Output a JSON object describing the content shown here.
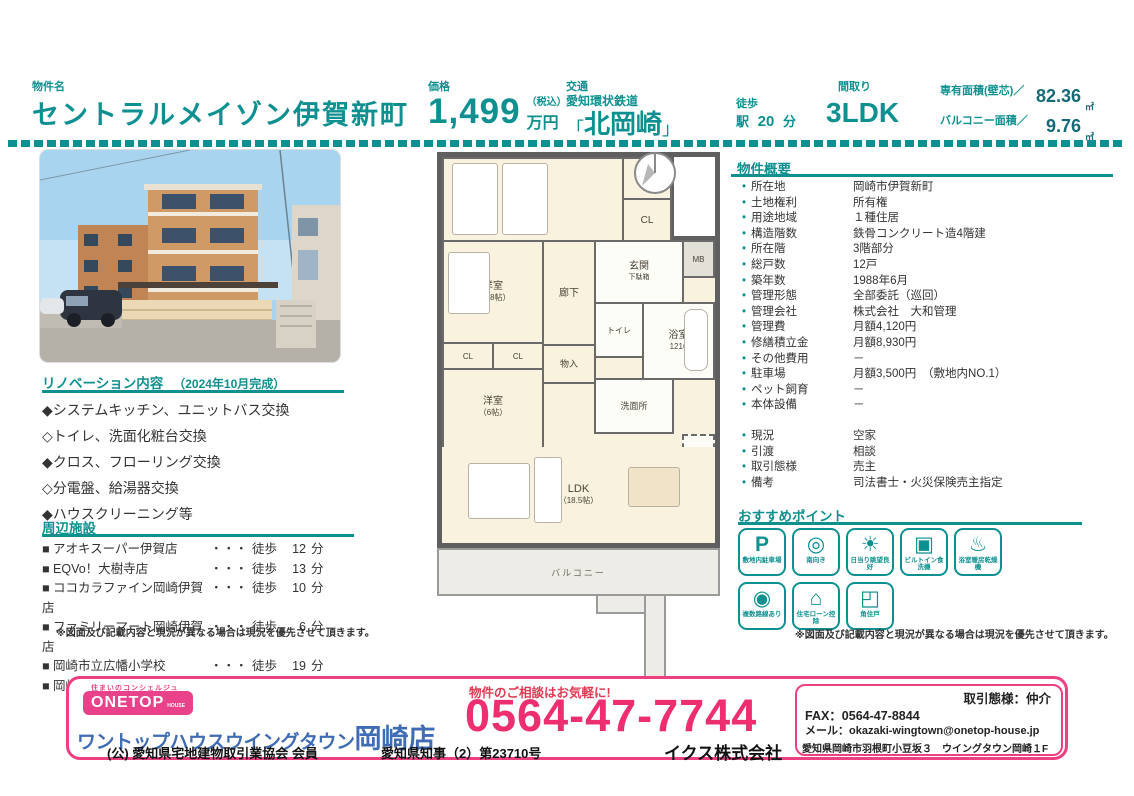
{
  "header": {
    "property_label": "物件名",
    "property_name": "セントラルメイゾン伊賀新町",
    "price_label": "価格",
    "price_value": "1,499",
    "price_tax": "（税込）",
    "price_unit": "万円",
    "access_label": "交通",
    "rail_line": "愛知環状鉄道",
    "bracket_open": "「",
    "station": "北岡崎",
    "bracket_close": "」",
    "walk_label": "徒歩",
    "station_suffix": "駅",
    "walk_minutes": "20",
    "minutes_unit": "分",
    "layout_label": "間取り",
    "layout_value": "3LDK",
    "area_label": "専有面積(壁芯)／",
    "area_value": "82.36",
    "area_unit": "㎡",
    "balcony_label": "バルコニー面積／",
    "balcony_value": "9.76",
    "balcony_unit": "㎡"
  },
  "renovation": {
    "title": "リノベーション内容",
    "completed": "（2024年10月完成）",
    "items": [
      "◆システムキッチン、ユニットバス交換",
      "◇トイレ、洗面化粧台交換",
      "◆クロス、フローリング交換",
      "◇分電盤、給湯器交換",
      "◆ハウスクリーニング等"
    ]
  },
  "facilities": {
    "title": "周辺施設",
    "dots": "・・・",
    "walk": "徒歩",
    "unit": "分",
    "items": [
      {
        "name": "■ アオキスーパー伊賀店",
        "min": "12"
      },
      {
        "name": "■ EQVo！大樹寺店",
        "min": "13"
      },
      {
        "name": "■ ココカラファイン岡崎伊賀店",
        "min": "10"
      },
      {
        "name": "■ ファミリーマート岡崎伊賀店",
        "min": "6"
      },
      {
        "name": "■ 岡崎市立広幡小学校",
        "min": "19"
      },
      {
        "name": "■ 岡崎市立葵中学校",
        "min": "7"
      }
    ],
    "note": "※図面及び記載内容と現況が異なる場合は現況を優先させて頂きます。"
  },
  "overview": {
    "title": "物件概要",
    "bullet": "●",
    "rows": [
      {
        "label": "所在地",
        "value": "岡崎市伊賀新町"
      },
      {
        "label": "土地権利",
        "value": "所有権"
      },
      {
        "label": "用途地域",
        "value": "１種住居"
      },
      {
        "label": "構造階数",
        "value": "鉄骨コンクリート造4階建"
      },
      {
        "label": "所在階",
        "value": "3階部分"
      },
      {
        "label": "総戸数",
        "value": "12戸"
      },
      {
        "label": "築年数",
        "value": "1988年6月"
      },
      {
        "label": "管理形態",
        "value": "全部委託（巡回）"
      },
      {
        "label": "管理会社",
        "value": "株式会社　大和管理"
      },
      {
        "label": "管理費",
        "value": "月額4,120円"
      },
      {
        "label": "修繕積立金",
        "value": "月額8,930円"
      },
      {
        "label": "その他費用",
        "value": "－"
      },
      {
        "label": "駐車場",
        "value": "月額3,500円　（敷地内NO.1）"
      },
      {
        "label": "ペット飼育",
        "value": "－"
      },
      {
        "label": "本体設備",
        "value": "－"
      }
    ],
    "rows2": [
      {
        "label": "現況",
        "value": "空家"
      },
      {
        "label": "引渡",
        "value": "相談"
      },
      {
        "label": "取引態様",
        "value": "売主"
      },
      {
        "label": "備考",
        "value": "司法書士・火災保険売主指定"
      }
    ]
  },
  "points": {
    "title": "おすすめポイント",
    "badges": [
      {
        "icon": "parking-icon",
        "glyph": "P",
        "label": "敷地内駐車場"
      },
      {
        "icon": "compass-icon",
        "glyph": "◎",
        "label": "南向き"
      },
      {
        "icon": "sun-icon",
        "glyph": "☀",
        "label": "日当り眺望良好"
      },
      {
        "icon": "dishwasher-icon",
        "glyph": "▣",
        "label": "ビルトイン食洗機"
      },
      {
        "icon": "bath-dryer-icon",
        "glyph": "♨",
        "label": "浴室暖房乾燥機"
      },
      {
        "icon": "train-icon",
        "glyph": "◉",
        "label": "複数路線あり"
      },
      {
        "icon": "house-loan-icon",
        "glyph": "⌂",
        "label": "住宅ローン控除"
      },
      {
        "icon": "corner-unit-icon",
        "glyph": "◰",
        "label": "角住戸"
      }
    ],
    "note": "※図面及び記載内容と現況が異なる場合は現況を優先させて頂きます。"
  },
  "floorplan": {
    "bed7": "洋室",
    "bed7_size": "（7帖）",
    "cl": "CL",
    "genkan": "玄関",
    "getabako": "下駄箱",
    "rouka": "廊下",
    "bed48": "洋室",
    "bed48_size": "（4.8帖）",
    "toilet": "トイレ",
    "mb": "MB",
    "monoire": "物入",
    "bath": "浴室",
    "bath_size": "1216",
    "senmen": "洗面所",
    "bed6": "洋室",
    "bed6_size": "（6帖）",
    "rei": "冷",
    "ldk": "LDK",
    "ldk_size": "（18.5帖）",
    "balcony": "バルコニー"
  },
  "footer": {
    "tagline": "住まいのコンシェルジュ",
    "logo_main": "ONETOP",
    "logo_sub": "HOUSE",
    "store_name": "ワントップハウスウイングタウン",
    "store_branch": "岡崎店",
    "cta": "物件のご相談はお気軽に!",
    "phone": "0564-47-7744",
    "deal_type": "取引態様：仲介",
    "fax": "FAX：0564-47-8844",
    "mail": "メール：okazaki-wingtown@onetop-house.jp",
    "address": "愛知県岡崎市羽根町小豆坂３　ウイングタウン岡崎１F",
    "member": "(公) 愛知県宅地建物取引業協会 会員",
    "license": "愛知県知事（2）第23710号",
    "company": "イクス株式会社"
  },
  "colors": {
    "teal": "#0e9090",
    "pink": "#ee3f83",
    "blue": "#3f6cb5"
  }
}
